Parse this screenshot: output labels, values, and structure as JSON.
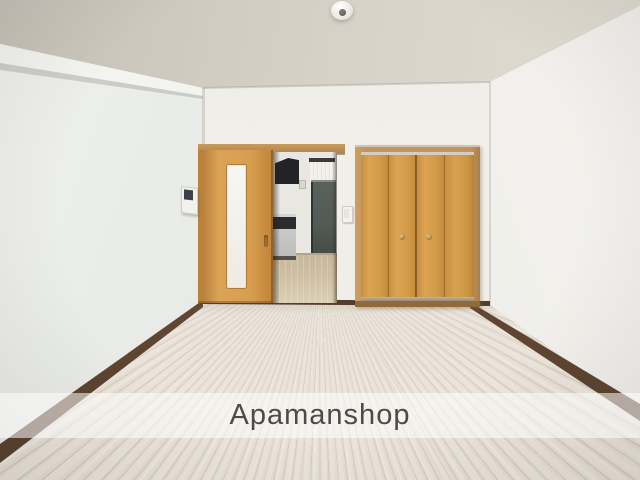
{
  "image": {
    "type": "interior-photograph",
    "description": "Empty apartment room with white walls, light wood-grain flooring, an orange wood sliding door standing open to a kitchen hallway with a black range hood and an entrance door, and a matching bi-fold closet on the right wall. Real-estate listing photo with a translucent watermark band."
  },
  "watermark": {
    "text": "Apamanshop"
  },
  "colors": {
    "watermark-text": "#4b4b4b",
    "watermark-band": "rgba(255,255,255,0.55)",
    "wall": "#f1efe9",
    "floor-wood": "#e8e2d8",
    "baseboard": "#543d2c",
    "door-wood": "#d89e4f",
    "closet-wood": "#d29a47",
    "hood": "#232327",
    "end-door": "#525a55",
    "hall-floor": "#cfc1a5"
  },
  "objects": {
    "ceiling_light": "round ceiling light mount",
    "sliding_door": "wood sliding door with vertical frosted-glass panel, slid open",
    "kitchen": "kitchen hallway seen through doorway: range hood, counter with stove, window blinds, entrance door",
    "closet": "double bi-fold closet doors with two round knobs",
    "intercom": "wall-mounted intercom panel",
    "light_switch": "wall light switch beside doorway",
    "flooring": "light laminate plank flooring with dark brown baseboards"
  }
}
